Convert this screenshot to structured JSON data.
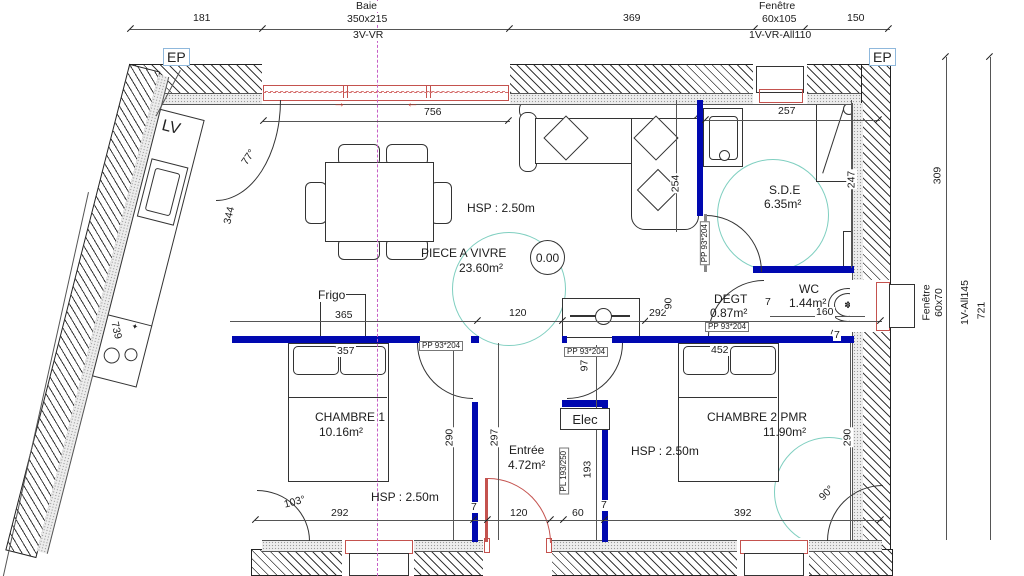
{
  "colors": {
    "wall_blue": "#0008b0",
    "opening_red": "#c4524e",
    "pmr_cyan": "#7fcfc0",
    "axis_magenta": "#c75fc7"
  },
  "icons": {
    "slide_arrow_right": "→",
    "slide_arrow_left": "←",
    "burner": "✦",
    "toilet_glyph": "✽"
  },
  "top": {
    "dim_left": "181",
    "bay_title": "Baie",
    "bay_size": "350x215",
    "bay_type": "3V-VR",
    "dim_mid": "369",
    "win_title": "Fenêtre",
    "win_size": "60x105",
    "win_type": "1V-VR-All110",
    "dim_right": "150",
    "ep_left": "EP",
    "ep_right": "EP",
    "inner_width": "756"
  },
  "right_dim": {
    "inner": "309",
    "outer": "721",
    "win_title": "Fenêtre",
    "win_size": "60x70",
    "win_type": "1V-All145"
  },
  "left_dim": {
    "outer": "739"
  },
  "kitchen": {
    "lv": "LV",
    "dim_344": "344",
    "angle": "77°"
  },
  "living": {
    "name": "PIECE A VIVRE",
    "area": "23.60m²",
    "hsp": "HSP : 2.50m",
    "level": "0.00",
    "frigo": "Frigo",
    "dim_365": "365",
    "dim_120": "120",
    "dim_292": "292",
    "dim_90": "90",
    "dim_254": "254"
  },
  "sde": {
    "name": "S.D.E",
    "area": "6.35m²",
    "dim_257": "257",
    "dim_247": "247",
    "ll": "L.L",
    "door_tag": "PP 93*204"
  },
  "degt": {
    "name": "DEGT",
    "area": "0.87m²",
    "dim_7": "7",
    "door_tag": "PP 93*204"
  },
  "wc": {
    "name": "WC",
    "area": "1.44m²",
    "dim_160": "160",
    "dim_7": "7"
  },
  "chambre1": {
    "name": "CHAMBRE 1",
    "area": "10.16m²",
    "hsp": "HSP : 2.50m",
    "dim_357": "357",
    "door_tag": "PP 93*204",
    "dim_290": "290",
    "dim_297": "297",
    "dim_292": "292",
    "dim_7": "7",
    "angle": "103°"
  },
  "entree": {
    "name": "Entrée",
    "area": "4.72m²",
    "dim_120": "120",
    "dim_60": "60",
    "dim_7": "7",
    "elec": "Elec",
    "closet_tag": "PL 193/250",
    "dim_193": "193",
    "dim_97": "97",
    "door_tag": "PP 93*204"
  },
  "chambre2": {
    "name": "CHAMBRE 2 PMR",
    "area": "11.90m²",
    "hsp": "HSP : 2.50m",
    "dim_452": "452",
    "dim_290": "290",
    "dim_392": "392",
    "angle": "90°",
    "dim_7": "7"
  }
}
